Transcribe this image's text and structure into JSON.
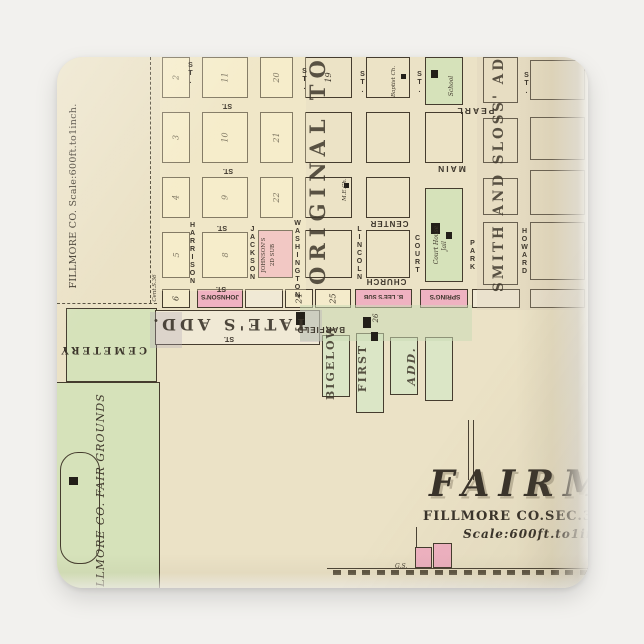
{
  "scene": {
    "background": "#f2f1ee"
  },
  "magnet": {
    "paper": "#ebe2c6",
    "radius": 26
  },
  "map": {
    "title": "FAIRMONT",
    "subtitle": "FILLMORE CO.SEC.30.T.8.",
    "scale_note": "Scale:600ft.to1inch."
  },
  "palette": {
    "ink": "#453c2e",
    "yellow": "#f4ebcb",
    "cream": "#ece3c6",
    "strip": "#f0e9d5",
    "pink": "#efb2c1",
    "green": "#d6e2ba",
    "green_lt": "#dbe6c6",
    "wash_green": "rgba(203,219,182,0.55)",
    "gray": "rgba(178,168,183,0.32)",
    "tan": "rgba(216,202,182,0.25)",
    "yellow_wash": "rgba(250,241,203,0.35)"
  },
  "regions": [
    [
      "yellow-wash-area",
      103,
      0,
      146,
      234,
      "yellow_wash",
      {
        "z": 3
      }
    ],
    [
      "tan-wash-area",
      420,
      0,
      111,
      253,
      "tan",
      {
        "z": 3
      }
    ],
    [
      "green-wash-area",
      243,
      248,
      172,
      36,
      "wash_green",
      {
        "z": 3
      }
    ],
    [
      "gray-area-west",
      93,
      255,
      32,
      36,
      "gray",
      {
        "z": 3
      }
    ],
    [
      "gray-area-east",
      243,
      253,
      22,
      32,
      "gray",
      {
        "z": 3
      }
    ],
    [
      "cemetery-block",
      9,
      251,
      91,
      74,
      "green",
      {
        "b": 1
      }
    ],
    [
      "fair-grounds-area",
      -3,
      325,
      106,
      210,
      "green",
      {
        "b": 1
      }
    ],
    [
      "racetrack-oval",
      3,
      395,
      40,
      112,
      "",
      {
        "b": 1,
        "r": 18
      }
    ],
    [
      "school-block",
      368,
      0,
      38,
      48,
      "green",
      {
        "b": 1
      }
    ],
    [
      "court-house-block",
      368,
      131,
      38,
      94,
      "green",
      {
        "b": 1
      }
    ],
    [
      "bigelow-column",
      265,
      278,
      28,
      62,
      "green_lt",
      {
        "b": 1,
        "lots": "h"
      }
    ],
    [
      "bigelow-column",
      299,
      276,
      28,
      80,
      "green_lt",
      {
        "b": 1,
        "lots": "h"
      }
    ],
    [
      "bigelow-column",
      333,
      280,
      28,
      58,
      "green_lt",
      {
        "b": 1,
        "lots": "h"
      }
    ],
    [
      "bigelow-column",
      368,
      280,
      28,
      64,
      "green_lt",
      {
        "b": 1,
        "lots": "h"
      }
    ],
    [
      "johnsons-2d-sub-block",
      201,
      173,
      35,
      48,
      "pink",
      {
        "b": 1,
        "lots": "v",
        "z": 2
      }
    ],
    [
      "johnsons-strip-block",
      140,
      232,
      46,
      19,
      "pink",
      {
        "b": 1,
        "lots": "v",
        "z": 2
      }
    ],
    [
      "b-lees-sub-block",
      298,
      232,
      57,
      19,
      "pink",
      {
        "b": 1,
        "lots": "v",
        "z": 2
      }
    ],
    [
      "springs-block",
      363,
      232,
      48,
      19,
      "pink",
      {
        "b": 1,
        "lots": "v",
        "z": 2
      }
    ],
    [
      "pink-square",
      358,
      490,
      17,
      21,
      "pink",
      {
        "b": 1
      }
    ],
    [
      "pink-square",
      376,
      486,
      19,
      25,
      "pink",
      {
        "b": 1
      }
    ]
  ],
  "blocks": [
    [
      105,
      0,
      28,
      41,
      "yellow",
      0,
      "2"
    ],
    [
      105,
      55,
      28,
      51,
      "yellow",
      0,
      "3"
    ],
    [
      105,
      120,
      28,
      41,
      "yellow",
      0,
      "4"
    ],
    [
      105,
      175,
      28,
      46,
      "yellow",
      0,
      "5"
    ],
    [
      145,
      0,
      46,
      41,
      "yellow",
      0,
      "11"
    ],
    [
      145,
      55,
      46,
      51,
      "yellow",
      0,
      "10"
    ],
    [
      145,
      120,
      46,
      41,
      "yellow",
      0,
      "9"
    ],
    [
      145,
      175,
      46,
      46,
      "yellow",
      0,
      "8"
    ],
    [
      203,
      0,
      33,
      41,
      "yellow",
      0,
      "20"
    ],
    [
      203,
      55,
      33,
      51,
      "yellow",
      0,
      "21"
    ],
    [
      203,
      120,
      33,
      41,
      "yellow",
      0,
      "22"
    ],
    [
      248,
      0,
      47,
      41,
      "cream",
      1,
      "19"
    ],
    [
      248,
      55,
      47,
      51,
      "cream",
      1,
      null
    ],
    [
      248,
      120,
      47,
      41,
      "cream",
      1,
      null
    ],
    [
      248,
      173,
      47,
      48,
      "cream",
      1,
      null
    ],
    [
      309,
      0,
      44,
      41,
      "cream",
      1,
      null
    ],
    [
      309,
      55,
      44,
      51,
      "cream",
      1,
      null
    ],
    [
      309,
      120,
      44,
      41,
      "cream",
      1,
      null
    ],
    [
      309,
      173,
      44,
      48,
      "cream",
      1,
      null
    ],
    [
      368,
      55,
      38,
      51,
      "cream",
      1,
      null
    ],
    [
      426,
      0,
      35,
      46,
      "cream",
      1,
      null
    ],
    [
      426,
      61,
      35,
      45,
      "cream",
      1,
      null
    ],
    [
      426,
      121,
      35,
      37,
      "cream",
      1,
      null
    ],
    [
      426,
      165,
      35,
      63,
      "cream",
      1,
      null
    ],
    [
      473,
      3,
      55,
      40,
      "cream",
      1,
      null
    ],
    [
      473,
      60,
      55,
      43,
      "cream",
      1,
      null
    ],
    [
      473,
      113,
      55,
      45,
      "cream",
      1,
      null
    ],
    [
      473,
      165,
      55,
      58,
      "cream",
      1,
      null
    ],
    [
      105,
      232,
      28,
      19,
      "yellow",
      0,
      "6"
    ],
    [
      188,
      232,
      38,
      19,
      "strip",
      1,
      null
    ],
    [
      228,
      232,
      28,
      19,
      "yellow",
      0,
      "24"
    ],
    [
      258,
      232,
      36,
      19,
      "yellow",
      0,
      "25"
    ],
    [
      415,
      232,
      48,
      19,
      "strip",
      1,
      null
    ],
    [
      473,
      232,
      55,
      19,
      "strip",
      1,
      null
    ],
    [
      98,
      253,
      165,
      35,
      "strip",
      1,
      null
    ]
  ],
  "street_names_vertical": [
    [
      "ST.",
      127,
      8,
      18
    ],
    [
      "HARRISON",
      129,
      171,
      52
    ],
    [
      "JACKSON",
      189,
      171,
      52
    ],
    [
      "WASHINGTON",
      234,
      164,
      78
    ],
    [
      "ST.",
      241,
      14,
      17
    ],
    [
      "LINCOLN",
      296,
      169,
      56
    ],
    [
      "ST.",
      299,
      17,
      17
    ],
    [
      "COURT",
      354,
      172,
      52
    ],
    [
      "ST.",
      356,
      17,
      17
    ],
    [
      "PARK",
      409,
      180,
      38
    ],
    [
      "HOWARD",
      461,
      169,
      52
    ],
    [
      "ST.",
      463,
      18,
      17
    ]
  ],
  "labels_flipped": [
    [
      "CENTER",
      311,
      162,
      42,
      8,
      {
        "ls": 1
      }
    ],
    [
      "CHURCH",
      308,
      220,
      42,
      8,
      {
        "ls": 1
      }
    ],
    [
      "PEARL",
      395,
      49,
      46,
      8.5,
      {
        "ls": 2
      }
    ],
    [
      "MAIN",
      375,
      107,
      38,
      8.5,
      {
        "ls": 2
      }
    ],
    [
      "BARFIELD",
      242,
      268,
      46,
      8,
      {
        "ls": 1
      }
    ],
    [
      "TATE'S ADD.",
      108,
      258,
      142,
      16,
      {
        "ls": 4,
        "serif": 1,
        "op": 0.9
      }
    ],
    [
      "CEMETERY",
      16,
      287,
      74,
      10,
      {
        "ls": 3,
        "serif": 1
      }
    ],
    [
      "JOHNSON'S",
      141,
      236,
      44,
      6.5,
      {}
    ],
    [
      "B. LEE'S SUB",
      299,
      236,
      55,
      6,
      {}
    ],
    [
      "SPRING'S",
      366,
      236,
      44,
      6.5,
      {}
    ],
    [
      "ST.",
      162,
      45,
      16,
      7,
      {}
    ],
    [
      "ST.",
      163,
      110,
      16,
      7,
      {}
    ],
    [
      "ST.",
      157,
      167,
      16,
      7,
      {}
    ],
    [
      "ST.",
      156,
      228,
      16,
      7,
      {}
    ],
    [
      "ST.",
      164,
      278,
      16,
      7,
      {}
    ]
  ],
  "labels_rotated": [
    [
      "ORIGINAL TOWN.",
      250,
      28,
      200,
      21,
      {
        "b": 1,
        "ls": 6,
        "op": 0.85,
        "n": "original-town-label"
      }
    ],
    [
      "SMITH AND SLOSS' ADD.",
      436,
      -2,
      237,
      13.5,
      {
        "b": 1,
        "ls": 3,
        "op": 0.85,
        "n": "smith-and-sloss-label"
      }
    ],
    [
      "BIGELOW",
      268,
      281,
      62,
      11,
      {
        "b": 1,
        "ls": 2,
        "op": 0.85,
        "n": "bigelow-first-add-label"
      }
    ],
    [
      "FIRST",
      300,
      279,
      64,
      11,
      {
        "b": 1,
        "ls": 2,
        "op": 0.85,
        "n": "bigelow-first-add-label"
      }
    ],
    [
      "ADD.",
      349,
      281,
      56,
      11,
      {
        "b": 1,
        "i": 1,
        "ls": 2,
        "op": 0.85,
        "n": "bigelow-first-add-label"
      }
    ],
    [
      "FILLMORE CO. FAIR GROUNDS",
      38,
      336,
      208,
      11,
      {
        "i": 1,
        "ls": 1,
        "n": "fair-grounds-label"
      }
    ],
    [
      "FILLMORE CO. Scale:600ft.to1inch.",
      12,
      28,
      222,
      9.5,
      {
        "ls": 0.3,
        "n": "margin-scale-label"
      }
    ],
    [
      "JOHNSON'S",
      205,
      176,
      44,
      5.5,
      {
        "n": "johnsons-2d-sub-label"
      }
    ],
    [
      "2D SUB",
      214,
      180,
      36,
      5.5,
      {
        "n": "johnsons-2d-sub-label"
      }
    ],
    [
      "Court House",
      377,
      168,
      40,
      6,
      {
        "i": 1,
        "n": "court-house-label"
      }
    ],
    [
      "Jail",
      385,
      176,
      26,
      6,
      {
        "i": 1,
        "n": "jail-label"
      }
    ],
    [
      "Baptist Ch.",
      335,
      10,
      30,
      5.5,
      {
        "i": 1,
        "n": "baptist-church-label"
      }
    ],
    [
      "School",
      392,
      14,
      30,
      6,
      {
        "i": 1,
        "n": "school-label"
      }
    ],
    [
      "M.E.Ch.",
      286,
      122,
      22,
      5.5,
      {
        "i": 1,
        "n": "me-church-label"
      }
    ],
    [
      "Cent.S.36",
      96,
      214,
      34,
      5.5,
      {
        "i": 1,
        "n": "section-corner-label"
      }
    ],
    [
      "26",
      316,
      254,
      14,
      7,
      {
        "i": 1,
        "n": "block-number"
      }
    ]
  ],
  "labels_plain": [
    [
      "G.S.",
      338,
      506
    ]
  ],
  "marks": [
    [
      374,
      13,
      7,
      8
    ],
    [
      344,
      17,
      5,
      5
    ],
    [
      287,
      126,
      5,
      5
    ],
    [
      374,
      166,
      9,
      11
    ],
    [
      389,
      175,
      6,
      7
    ],
    [
      12,
      420,
      9,
      8
    ],
    [
      239,
      255,
      9,
      13
    ],
    [
      306,
      260,
      8,
      11
    ],
    [
      314,
      275,
      7,
      9
    ]
  ],
  "lines": [
    [
      93,
      0,
      1,
      246,
      "dashed-v"
    ],
    [
      0,
      246,
      100,
      1,
      "dashed-h"
    ],
    [
      270,
      511,
      261,
      1,
      "solid"
    ],
    [
      411,
      363,
      1,
      60,
      "solid"
    ],
    [
      416,
      363,
      1,
      60,
      "solid"
    ],
    [
      359,
      470,
      1,
      20,
      "solid"
    ]
  ],
  "ticks": {
    "x0": 276,
    "y": 513,
    "step": 14.5,
    "w": 8,
    "h": 5,
    "count": 18
  }
}
